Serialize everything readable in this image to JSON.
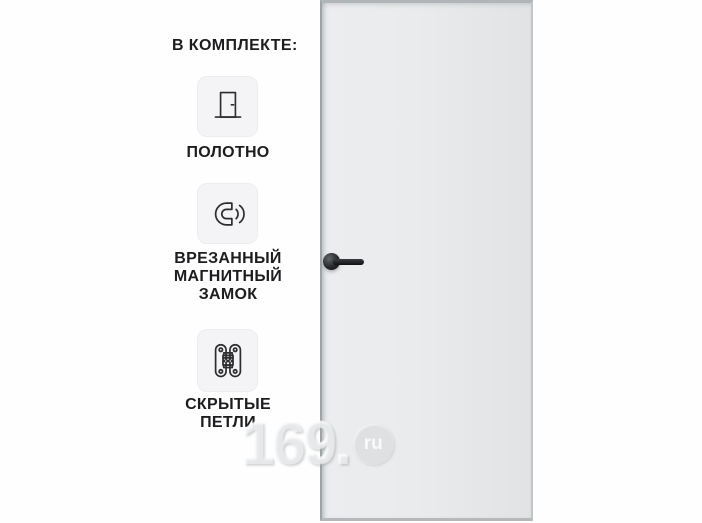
{
  "card": {
    "background": "#fefefe"
  },
  "features": {
    "header": "В КОМПЛЕКТЕ:",
    "items": [
      {
        "icon": "door-leaf-icon",
        "label": "ПОЛОТНО"
      },
      {
        "icon": "magnet-lock-icon",
        "label": "ВРЕЗАННЫЙ\nМАГНИТНЫЙ\nЗАМОК"
      },
      {
        "icon": "hidden-hinge-icon",
        "label": "СКРЫТЫЕ\nПЕТЛИ"
      }
    ]
  },
  "product": {
    "name": "door-leaf-render",
    "panel_color": "#e9eaec",
    "edge_color": "#b2b5b7",
    "handle_color": "#141517"
  },
  "watermark": {
    "number": "169.",
    "suffix": "ru"
  }
}
